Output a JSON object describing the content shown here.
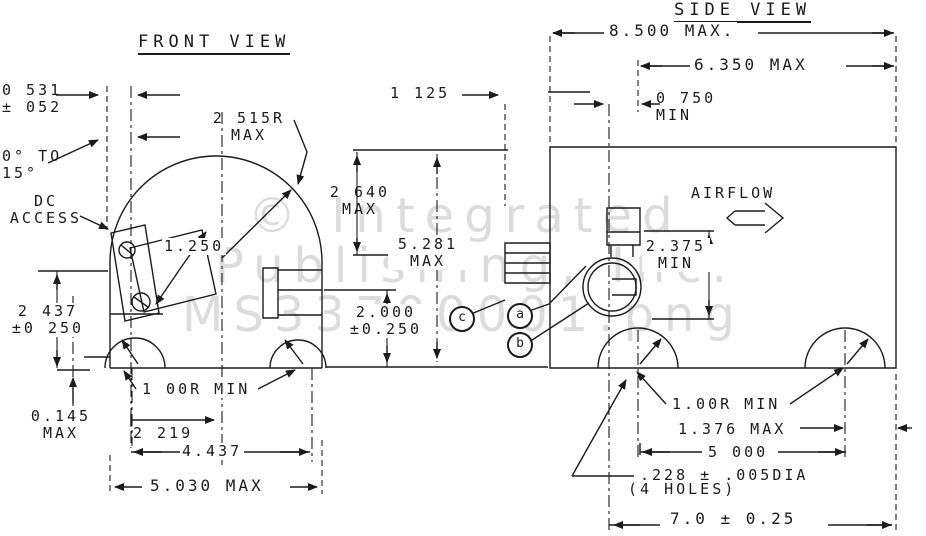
{
  "doc_type": "engineering-drawing",
  "colors": {
    "ink": "#1b1b1b",
    "watermark": "#dcdcdc",
    "background": "#ffffff"
  },
  "watermark": {
    "line1": "© Integrated",
    "line2": "Publishing, Inc.",
    "line3": "MS33700001.png"
  },
  "front_view": {
    "title": "FRONT VIEW",
    "labels": {
      "dim_0531_l1": "0 531",
      "dim_0531_l2": "± 052",
      "angle_l1": "0° TO",
      "angle_l2": "15°",
      "dc_access_l1": "DC",
      "dc_access_l2": "ACCESS",
      "dome_radius_l1": "2 515R",
      "dome_radius_l2": "MAX",
      "dim_1250": "1.250",
      "dim_2640_l1": "2 640",
      "dim_2640_l2": "MAX",
      "dim_2437_l1": "2 437",
      "dim_2437_l2": "±0 250",
      "dim_0145_l1": "0.145",
      "dim_0145_l2": "MAX",
      "foot_radius": "1 00R MIN",
      "dim_2219": "2 219",
      "dim_4437": "4.437",
      "dim_5030": "5.030 MAX"
    }
  },
  "between_views": {
    "dim_1125": "1 125",
    "dim_5281_l1": "5.281",
    "dim_5281_l2": "MAX",
    "dim_2000_l1": "2.000",
    "dim_2000_l2": "±0.250",
    "balloons": [
      "c",
      "a",
      "b"
    ]
  },
  "side_view": {
    "title": "SIDE VIEW",
    "labels": {
      "dim_8500": "8.500 MAX.",
      "dim_6350": "6.350 MAX",
      "dim_0750_l1": "0 750",
      "dim_0750_l2": "MIN",
      "airflow": "AIRFLOW",
      "dim_2375_l1": "2.375",
      "dim_2375_l2": "MIN",
      "foot_radius": "1.00R MIN",
      "dim_1376": "1.376 MAX",
      "dim_5000": "5 000",
      "dim_228": ".228 ± .005DIA",
      "dim_228_holes": "(4 HOLES)",
      "dim_70": "7.0 ± 0.25"
    }
  }
}
